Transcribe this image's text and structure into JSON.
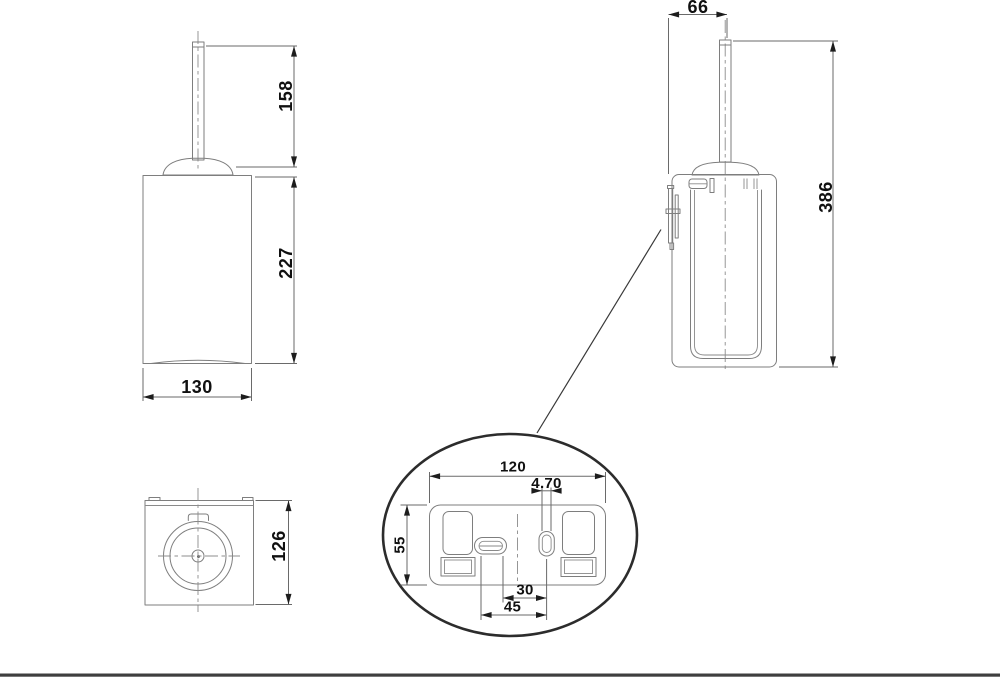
{
  "drawing": {
    "kind": "technical-dimension-drawing",
    "subject": "wall-mounted toilet brush holder",
    "colors": {
      "background": "#ffffff",
      "geometry_line": "#7e7e7e",
      "dimension_line": "#6a6a6a",
      "centerline": "#8c8c8c",
      "detail_ellipse": "#2c2c2c",
      "text": "#101010",
      "footer_bar": "#3f3f3f"
    }
  },
  "views": {
    "front": {
      "dims": {
        "handle_height": "158",
        "body_height": "227",
        "body_width": "130"
      }
    },
    "side": {
      "dims": {
        "wall_offset": "66",
        "total_height": "386"
      }
    },
    "top": {
      "dims": {
        "depth": "126"
      }
    },
    "detail": {
      "dims": {
        "plate_width": "120",
        "slot_width": "4.70",
        "plate_height": "55",
        "slot_spacing_inner": "30",
        "slot_spacing_outer": "45"
      }
    }
  }
}
